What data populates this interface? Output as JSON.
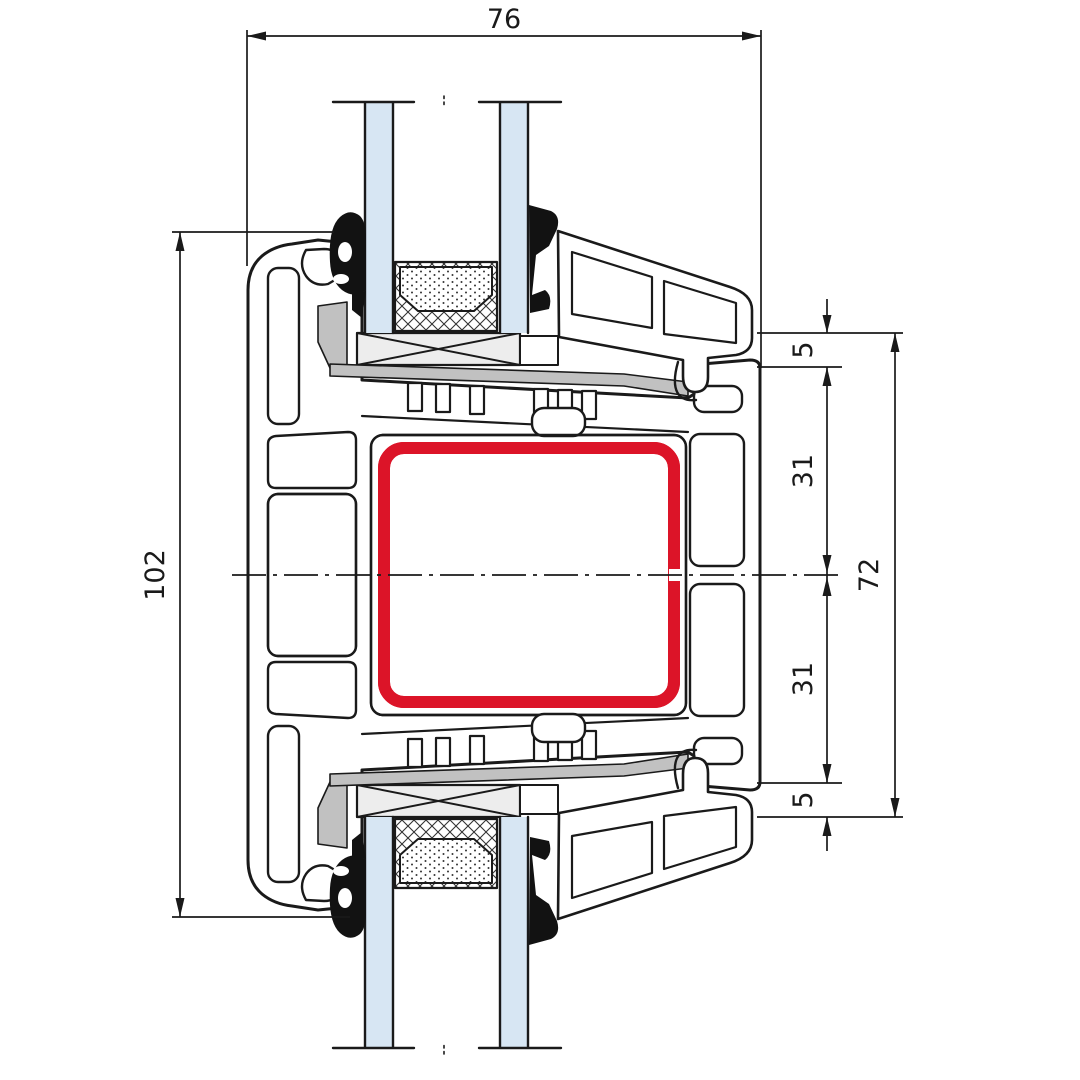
{
  "drawing": {
    "title": "window-profile-cross-section",
    "dimensions": {
      "width_top": "76",
      "height_left": "102",
      "right_segment_1": "5",
      "right_segment_2": "31",
      "right_segment_3": "31",
      "right_segment_4": "5",
      "height_right_total": "72"
    },
    "colors": {
      "line": "#1a1a1a",
      "steel_red": "#dc1428",
      "glass_blue": "#d7e6f3",
      "packer_gray": "#c1c1c1",
      "block_gray": "#ededed",
      "gasket_black": "#121212",
      "background": "#ffffff"
    }
  }
}
